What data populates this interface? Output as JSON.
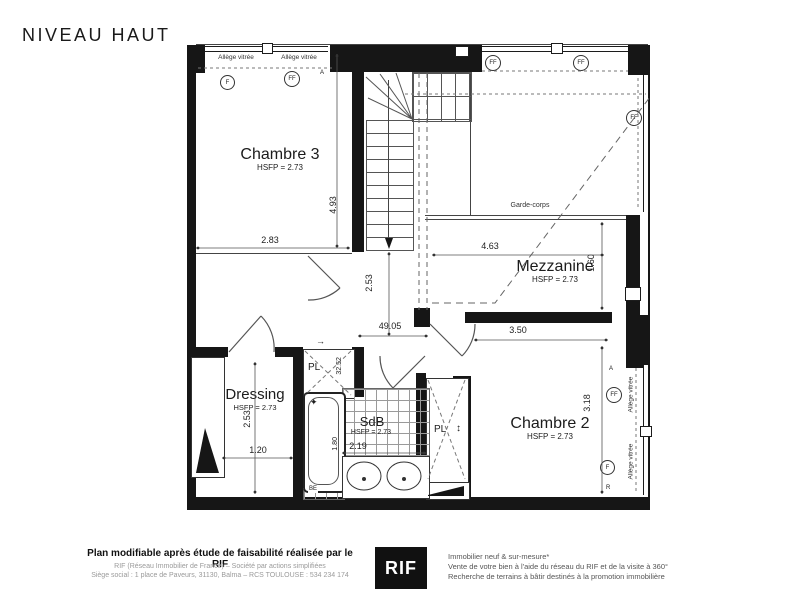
{
  "title": "NIVEAU HAUT",
  "rooms": {
    "chambre3": {
      "name": "Chambre 3",
      "hsfp": "HSFP = 2.73"
    },
    "mezzanine": {
      "name": "Mezzanine",
      "hsfp": "HSFP = 2.73"
    },
    "dressing": {
      "name": "Dressing",
      "hsfp": "HSFP = 2.73"
    },
    "sdb": {
      "name": "SdB",
      "hsfp": "HSFP = 2.73"
    },
    "chambre2": {
      "name": "Chambre 2",
      "hsfp": "HSFP = 2.73"
    }
  },
  "labels": {
    "garde_corps": "Garde-corps",
    "allege_vitree": "Allège vitrée",
    "pl": "PL",
    "f": "F",
    "ff": "FF",
    "r": "R",
    "a": "A",
    "be": "BE"
  },
  "glyphs": {
    "slide_arrow": "→",
    "updown_arrow": "↕",
    "faucet_star": "✦"
  },
  "dims": {
    "chambre3_w": "2.83",
    "chambre3_h": "4.93",
    "mezzanine_w": "4.63",
    "mezzanine_h": "1.60",
    "chambre2_w": "3.50",
    "chambre2_h": "3.18",
    "landing_h": "2.53",
    "landing_w": "49.05",
    "dressing_h": "2.53",
    "dressing_w": "1.20",
    "sdb_w": "2.19",
    "sdb_h": "1.80",
    "pl_d": "32.52"
  },
  "footer": {
    "left_bold": "Plan modifiable après étude de faisabilité réalisée par le RIF",
    "left_line2": "RIF (Réseau Immobilier de France) – Société par actions simplifiées",
    "left_line3": "Siège social : 1 place de Paveurs, 31130, Balma – RCS TOULOUSE : 534 234 174",
    "logo": "RIF",
    "right_line1": "Immobilier neuf & sur-mesure*",
    "right_line2": "Vente de votre bien à l'aide du réseau du RIF et de la visite à 360°",
    "right_line3": "Recherche de terrains à bâtir destinés à la promotion immobilière"
  },
  "colors": {
    "wall": "#161616",
    "line": "#444",
    "text": "#1c1c1c",
    "muted": "#999"
  }
}
